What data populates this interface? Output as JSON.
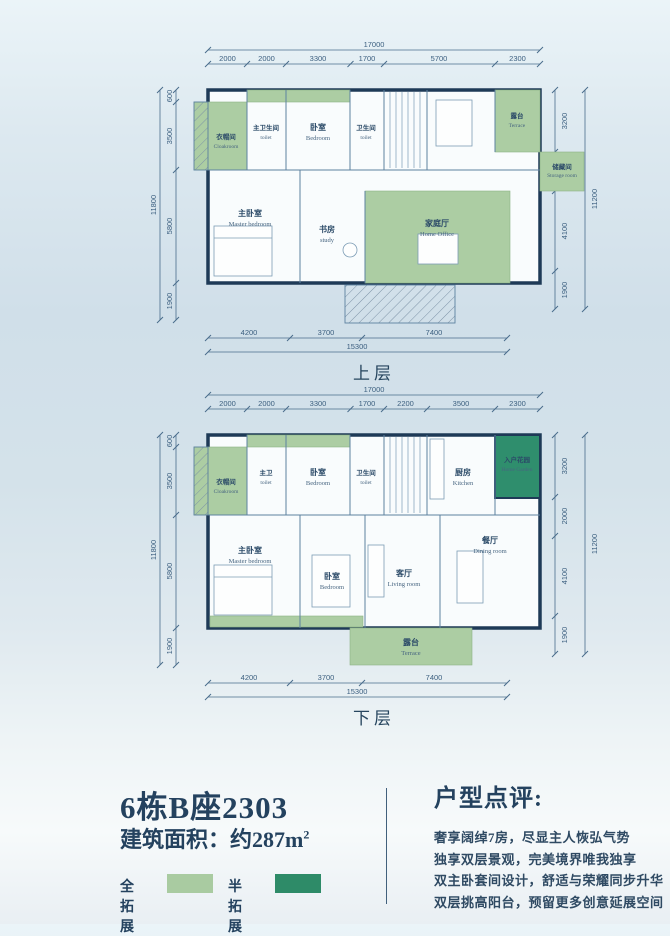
{
  "colors": {
    "background_blue": "#d4e2ea",
    "light_green_full_extension": "#a9cba1",
    "dark_green_half_extension": "#2e8b68",
    "wall": "#1e3a57",
    "dimension_text": "#3d6080",
    "heading_text": "#24425f"
  },
  "upper": {
    "floor_label": "上层",
    "dims": {
      "top_total": "17000",
      "top_segs": [
        "2000",
        "2000",
        "3300",
        "1700",
        "5700",
        "2300"
      ],
      "left_total": "11800",
      "left_segs": [
        "600",
        "3500",
        "5800",
        "1900"
      ],
      "right_total": "11200",
      "right_segs": [
        "3200",
        "2000",
        "4100",
        "1900"
      ],
      "bottom_segs": [
        "4200",
        "3700",
        "7400"
      ],
      "bottom_total": "15300"
    },
    "rooms": {
      "cloakroom": {
        "cn": "衣帽间",
        "en": "Cloakroom"
      },
      "master_toilet": {
        "cn": "主卫生间",
        "en": "toilet"
      },
      "bedroom": {
        "cn": "卧室",
        "en": "Bedroom"
      },
      "toilet": {
        "cn": "卫生间",
        "en": "toilet"
      },
      "master_bedroom": {
        "cn": "主卧室",
        "en": "Master bedroom"
      },
      "study": {
        "cn": "书房",
        "en": "study"
      },
      "home_office": {
        "cn": "家庭厅",
        "en": "Home Office"
      },
      "terrace": {
        "cn": "露台",
        "en": "Terrace"
      },
      "storage": {
        "cn": "储藏间",
        "en": "Storage room"
      }
    }
  },
  "lower": {
    "floor_label": "下层",
    "dims": {
      "top_total": "17000",
      "top_segs": [
        "2000",
        "2000",
        "3300",
        "1700",
        "2200",
        "3500",
        "2300"
      ],
      "left_total": "11800",
      "left_segs": [
        "600",
        "3500",
        "5800",
        "1900"
      ],
      "right_total": "11200",
      "right_segs": [
        "3200",
        "2000",
        "4100",
        "1900"
      ],
      "bottom_segs": [
        "4200",
        "3700",
        "7400"
      ],
      "bottom_total": "15300"
    },
    "rooms": {
      "cloakroom": {
        "cn": "衣帽间",
        "en": "Cloakroom"
      },
      "master_toilet": {
        "cn": "主卫",
        "en": "toilet"
      },
      "bedroom1": {
        "cn": "卧室",
        "en": "Bedroom"
      },
      "toilet": {
        "cn": "卫生间",
        "en": "toilet"
      },
      "kitchen": {
        "cn": "厨房",
        "en": "Kitchen"
      },
      "home_garden": {
        "cn": "入户花园",
        "en": "Home Garden"
      },
      "master_bedroom": {
        "cn": "主卧室",
        "en": "Master bedroom"
      },
      "bedroom2": {
        "cn": "卧室",
        "en": "Bedroom"
      },
      "living": {
        "cn": "客厅",
        "en": "Living room"
      },
      "dining": {
        "cn": "餐厅",
        "en": "Dining room"
      },
      "terrace": {
        "cn": "露台",
        "en": "Terrace"
      }
    }
  },
  "info": {
    "unit_title": "6栋B座2303",
    "area_prefix": "建筑面积：约287m",
    "area_sup": "2",
    "legend": {
      "full": "全拓展",
      "half": "半拓展"
    },
    "review_title": "户型点评:",
    "review_lines": [
      "奢享阔绰7房，尽显主人恢弘气势",
      "独享双层景观，完美境界唯我独享",
      "双主卧套间设计，舒适与荣耀同步升华",
      "双层挑高阳台，预留更多创意延展空间"
    ]
  }
}
